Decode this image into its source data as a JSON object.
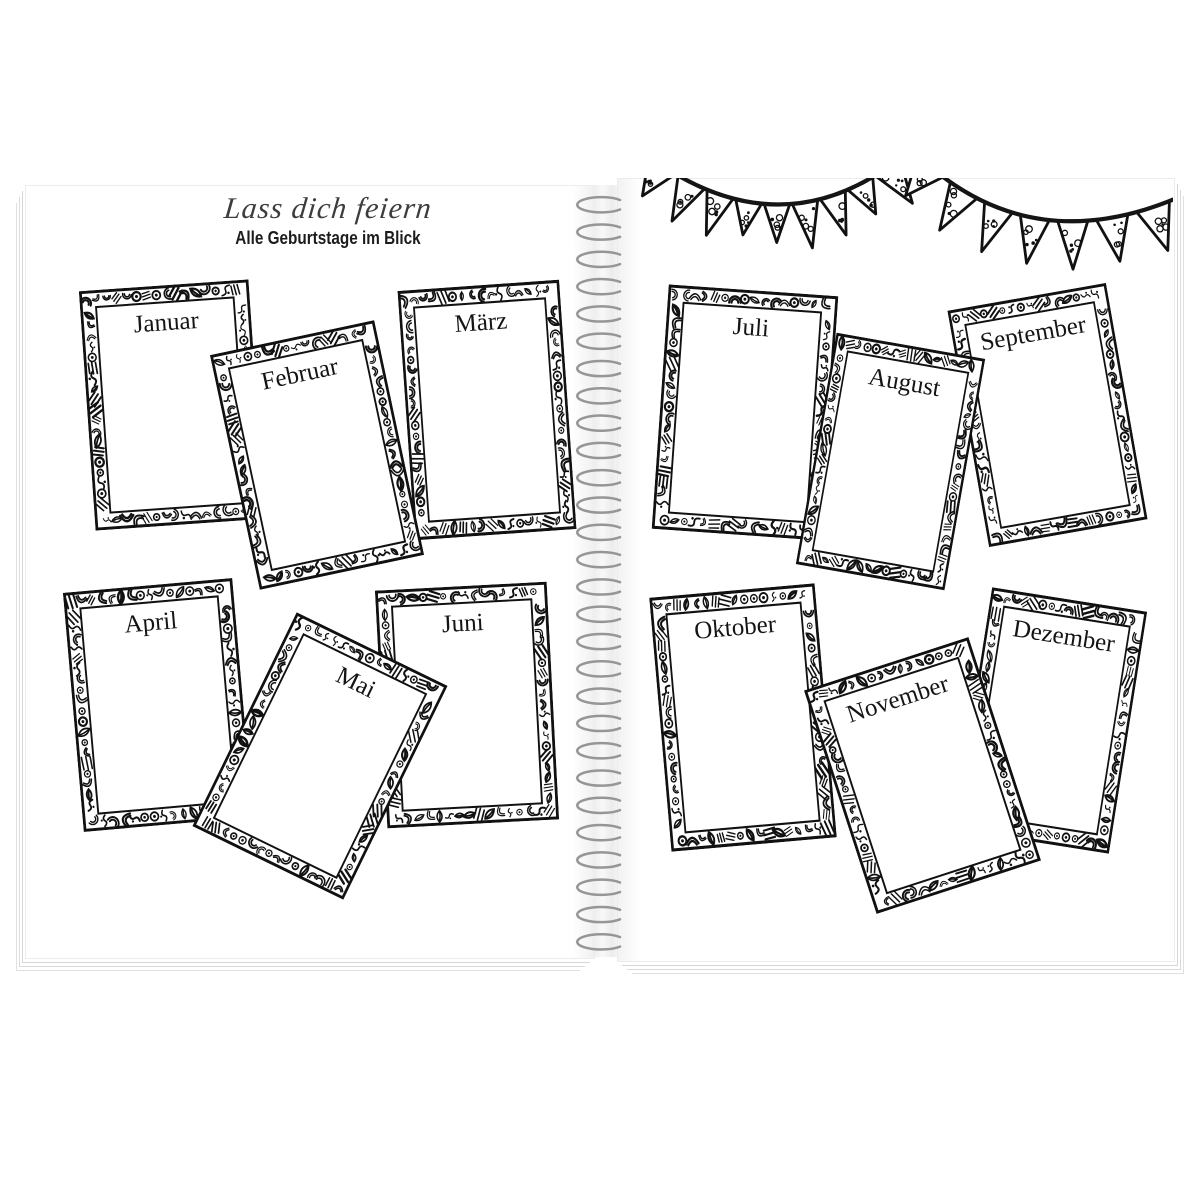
{
  "header": {
    "title": "Lass dich feiern",
    "subtitle": "Alle Geburtstage im Blick"
  },
  "months": {
    "left": [
      "Januar",
      "Februar",
      "März",
      "April",
      "Mai",
      "Juni"
    ],
    "right": [
      "Juli",
      "August",
      "September",
      "Oktober",
      "November",
      "Dezember"
    ]
  },
  "decorations": {
    "bunting_icon": "pennant-banner",
    "binding_icon": "spiral-wire-binding",
    "frame_style": "doodle-coloring-border"
  },
  "colors": {
    "ink": "#111111",
    "page": "#ffffff",
    "spiral_wire": "#969696",
    "page_edge": "#d6d6d6",
    "title_ink": "#3d3d3d"
  }
}
